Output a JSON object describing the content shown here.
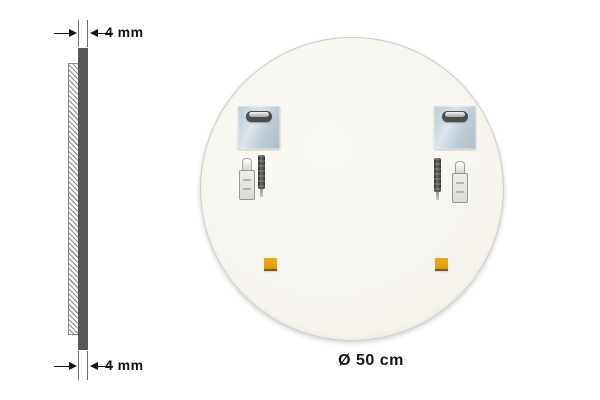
{
  "annotations": {
    "thickness_top": "4 mm",
    "thickness_bottom": "4 mm",
    "diameter": "Ø 50 cm"
  },
  "parts": {
    "mounting_plate": "steel-hanging-plate-with-keyhole-slot",
    "hardware": "adhesive-bottle-and-screw-bit",
    "pad": "orange-adhesive-pad"
  },
  "colors": {
    "background": "#ffffff",
    "mirror_back_fill": "#f8f6f0",
    "glass_edge_gray": "#57585a",
    "bracket_steel": "#c4d0da",
    "adhesive_pad_orange": "#e29c13",
    "annotation_text": "#111111"
  }
}
